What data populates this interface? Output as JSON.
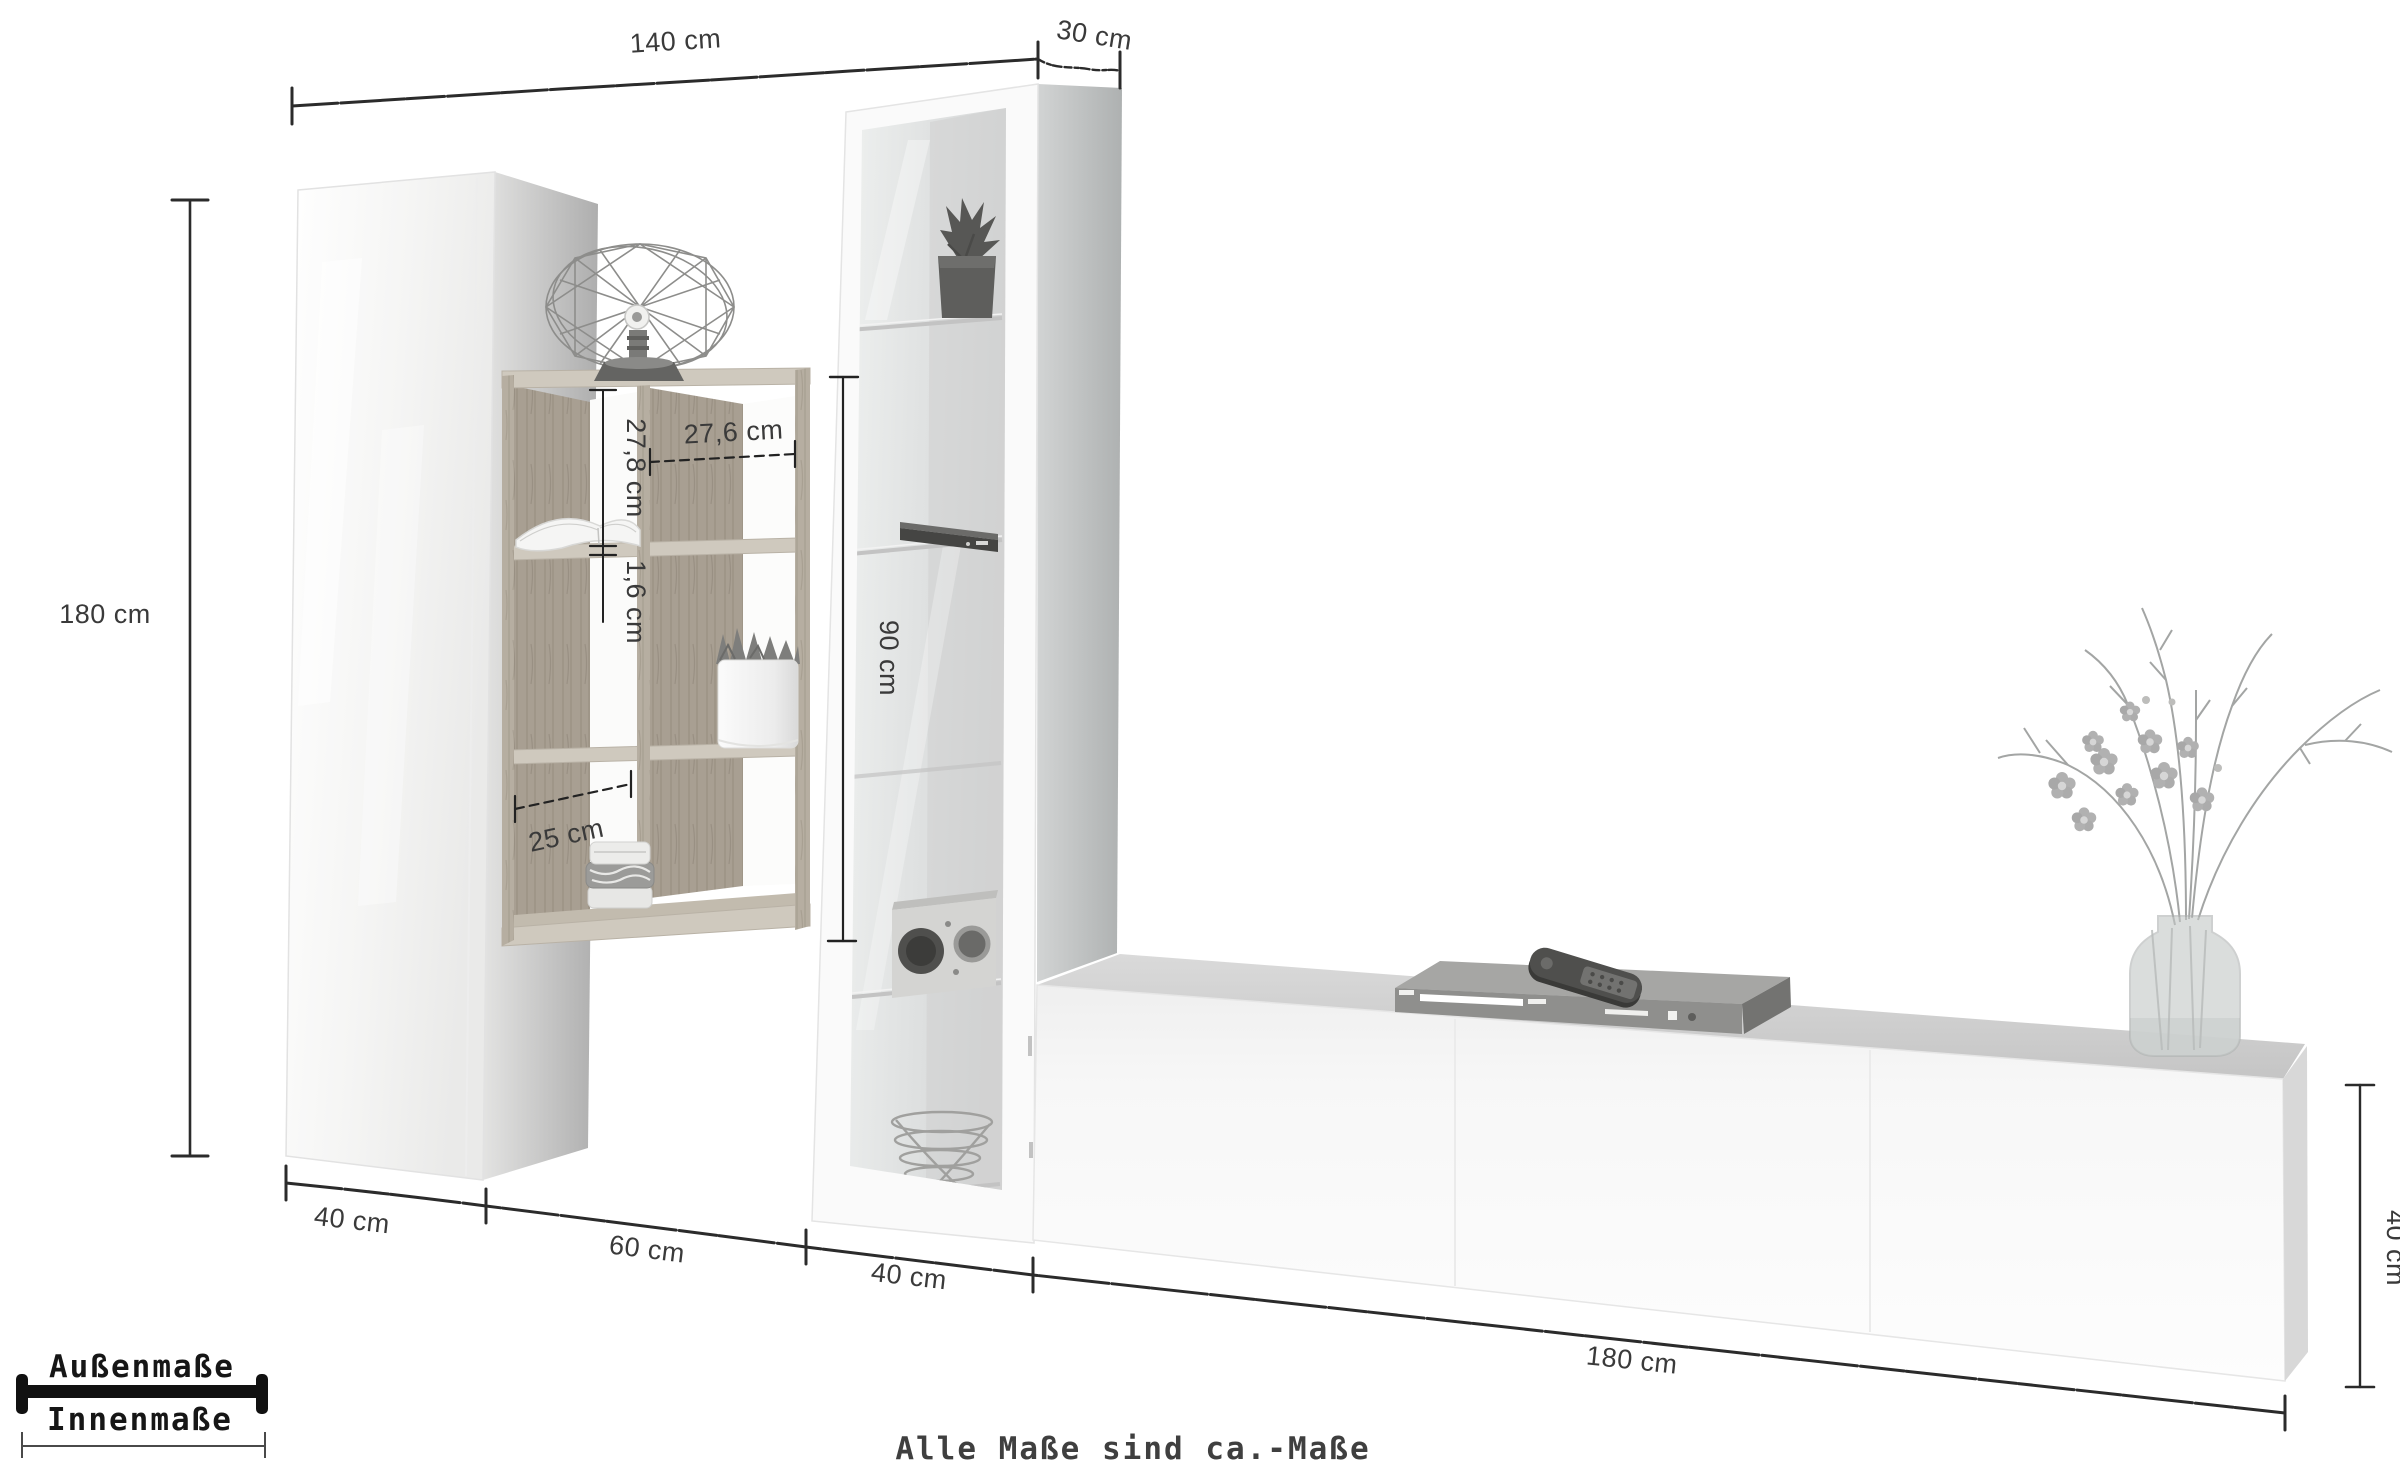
{
  "diagram": {
    "title": "wall-unit-dimension-diagram",
    "footnote": "Alle Maße sind ca.-Maße",
    "legend": {
      "outer": "Außenmaße",
      "inner": "Innenmaße"
    },
    "dims": {
      "total_width": "140 cm",
      "depth": "30 cm",
      "total_height": "180 cm",
      "cabinet_width": "40 cm",
      "shelf_width": "60 cm",
      "vitrine_width": "40 cm",
      "lowboard_length": "180 cm",
      "lowboard_height": "40 cm",
      "vitrine_inner_height": "90 cm",
      "cube_inner_height": "27,8 cm",
      "cube_inner_width": "27,6 cm",
      "board_thickness": "1,6 cm",
      "cube_depth": "25 cm"
    },
    "colors": {
      "line": "#2b2b2b",
      "label": "#3a3a3a",
      "wood": "#b3ab9e",
      "background": "#ffffff"
    }
  }
}
